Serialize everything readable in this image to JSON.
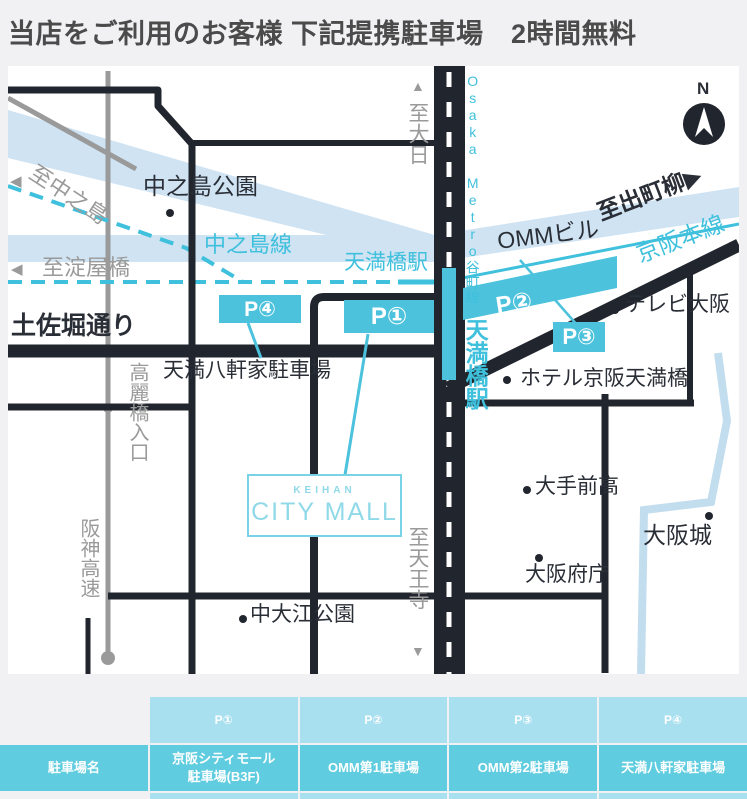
{
  "header": {
    "title": "当店をご利用のお客様 下記提携駐車場　2時間無料"
  },
  "map": {
    "labels": {
      "to_nakanoshima": "至中之島",
      "to_yodoyabashi": "至淀屋橋",
      "nakanoshima_park": "中之島公園",
      "nakanoshima_line": "中之島線",
      "tenmabashi_station_metro": "天満橋駅",
      "tenmabashi_station_keihan": "天満橋駅",
      "osaka_metro_tanimachi_line": "Osaka Metro谷町線",
      "to_dainichi": "至大日",
      "to_tennoji": "至天王寺",
      "tosabori_street": "土佐堀通り",
      "temma_hachikenya_parking": "天満八軒家駐車場",
      "omm_building": "OMMビル",
      "to_demachiyanagi": "至出町柳",
      "keihan_main_line": "京阪本線",
      "tv_osaka": "テレビ大阪",
      "hotel_keihan_tenmabashi": "ホテル京阪天満橋",
      "otemae_high_school": "大手前高",
      "osaka_castle": "大阪城",
      "osaka_pref_office": "大阪府庁",
      "naka_oe_park": "中大江公園",
      "koraibashi_entrance": "高麗橋入口",
      "hanshin_expressway": "阪神高速"
    },
    "badges": {
      "p1": "P①",
      "p2": "P②",
      "p3": "P③",
      "p4": "P④"
    },
    "city_mall": {
      "brand": "KEIHAN",
      "name": "CITY MALL"
    },
    "compass": {
      "north": "N"
    },
    "arrows": {
      "left": "◀",
      "right": "▶",
      "up": "▲",
      "down": "▼"
    }
  },
  "table": {
    "header": {
      "c1": "P①",
      "c2": "P②",
      "c3": "P③",
      "c4": "P④"
    },
    "names": {
      "c0": "駐車場名",
      "c1_line1": "京阪シティモール",
      "c1_line2": "駐車場(B3F)",
      "c2": "OMM第1駐車場",
      "c3": "OMM第2駐車場",
      "c4": "天満八軒家駐車場"
    }
  },
  "colors": {
    "page_bg": "#f1f1f3",
    "road_black": "#21252e",
    "transit_cyan": "#3fc0dc",
    "badge_cyan": "#4cc2dc",
    "river_blue": "#cfe3f3",
    "moat_blue": "#c2ddee",
    "gray": "#9a9a9a",
    "table_row_light": "#a9e0f0",
    "table_row_dark": "#5fccdf"
  }
}
